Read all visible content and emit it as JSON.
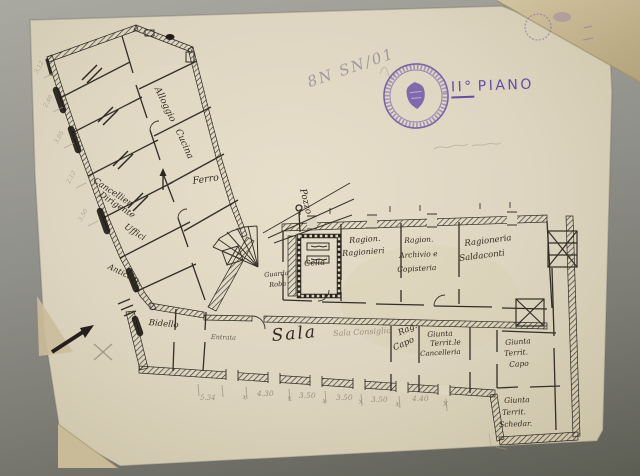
{
  "annotations": {
    "catalog_number": "8N SN/01"
  },
  "stamp": {
    "floor_label_prefix": "II°",
    "floor_label_word": "PIANO",
    "icon": "round-purple-ink-stamp"
  },
  "colors": {
    "paper": "#ddd5c0",
    "paper_fold": "#c8b995",
    "background_gray": "#8c8c84",
    "ink": "#2e2922",
    "pencil": "#a09884",
    "stamp_purple": "#6a4fae"
  },
  "plan": {
    "labels": [
      {
        "name": "room-label-alloggio",
        "text": "Alloggio",
        "x": 160,
        "y": 86,
        "rot": 64,
        "size": 9,
        "cls": "ink"
      },
      {
        "name": "room-label-cucina",
        "text": "Cucina",
        "x": 181,
        "y": 128,
        "rot": 66,
        "size": 9,
        "cls": "ink"
      },
      {
        "name": "room-label-ferro",
        "text": "Ferro",
        "x": 192,
        "y": 177,
        "rot": -8,
        "size": 9.5,
        "cls": "ink"
      },
      {
        "name": "room-label-cancelliere-line1",
        "text": "Cancellier.",
        "x": 96,
        "y": 177,
        "rot": 33,
        "size": 8.5,
        "cls": "ink"
      },
      {
        "name": "room-label-cancelliere-line2",
        "text": "Dirigente",
        "x": 102,
        "y": 191,
        "rot": 33,
        "size": 8.5,
        "cls": "ink"
      },
      {
        "name": "room-label-uffici",
        "text": "Uffici",
        "x": 127,
        "y": 223,
        "rot": 33,
        "size": 8.5,
        "cls": "ink"
      },
      {
        "name": "room-label-anticamera",
        "text": "Anticam.",
        "x": 110,
        "y": 263,
        "rot": 26,
        "size": 8,
        "cls": "ink"
      },
      {
        "name": "room-label-bidello",
        "text": "Bidello",
        "x": 149,
        "y": 319,
        "rot": 5,
        "size": 8.5,
        "cls": "ink"
      },
      {
        "name": "room-label-entrata",
        "text": "Entrata",
        "x": 211,
        "y": 334,
        "rot": 2,
        "size": 6.5,
        "cls": "ink faint"
      },
      {
        "name": "room-label-sala",
        "text": "Sala",
        "x": 271,
        "y": 328,
        "rot": -5,
        "size": 17,
        "cls": "ink big"
      },
      {
        "name": "room-label-sala-consiglio",
        "text": "Sala Consiglio",
        "x": 333,
        "y": 330,
        "rot": -3,
        "size": 8,
        "cls": "pencil"
      },
      {
        "name": "room-label-rag-capo-line1",
        "text": "Rag.",
        "x": 397,
        "y": 330,
        "rot": -24,
        "size": 8.5,
        "cls": "ink"
      },
      {
        "name": "room-label-rag-capo-line2",
        "text": "Capo",
        "x": 392,
        "y": 345,
        "rot": -24,
        "size": 8.5,
        "cls": "ink"
      },
      {
        "name": "room-label-giunta-cancelleria-line1",
        "text": "Giunta",
        "x": 427,
        "y": 331,
        "rot": -3,
        "size": 7.5,
        "cls": "ink"
      },
      {
        "name": "room-label-giunta-cancelleria-line2",
        "text": "Territ.le",
        "x": 430,
        "y": 340,
        "rot": -3,
        "size": 7.5,
        "cls": "ink"
      },
      {
        "name": "room-label-giunta-cancelleria-line3",
        "text": "Cancelleria",
        "x": 420,
        "y": 351,
        "rot": -3,
        "size": 7,
        "cls": "ink"
      },
      {
        "name": "room-label-giunta-capo-line1",
        "text": "Giunta",
        "x": 505,
        "y": 339,
        "rot": -4,
        "size": 7.5,
        "cls": "ink"
      },
      {
        "name": "room-label-giunta-capo-line2",
        "text": "Territ.",
        "x": 504,
        "y": 350,
        "rot": -4,
        "size": 7.5,
        "cls": "ink"
      },
      {
        "name": "room-label-giunta-capo-line3",
        "text": "Capo",
        "x": 509,
        "y": 361,
        "rot": -4,
        "size": 7.5,
        "cls": "ink"
      },
      {
        "name": "room-label-giunta-schedario-line1",
        "text": "Giunta",
        "x": 504,
        "y": 397,
        "rot": -2,
        "size": 7.5,
        "cls": "ink"
      },
      {
        "name": "room-label-giunta-schedario-line2",
        "text": "Territ.",
        "x": 502,
        "y": 409,
        "rot": -2,
        "size": 7.5,
        "cls": "ink"
      },
      {
        "name": "room-label-giunta-schedario-line3",
        "text": "Schedar.",
        "x": 499,
        "y": 421,
        "rot": -2,
        "size": 7.5,
        "cls": "ink"
      },
      {
        "name": "room-label-ragionieri-line1",
        "text": "Ragion.",
        "x": 349,
        "y": 237,
        "rot": -4,
        "size": 8,
        "cls": "ink"
      },
      {
        "name": "room-label-ragionieri-line2",
        "text": "Ragionieri",
        "x": 342,
        "y": 250,
        "rot": -4,
        "size": 8,
        "cls": "ink"
      },
      {
        "name": "room-label-archivio-line1",
        "text": "Ragion.",
        "x": 404,
        "y": 237,
        "rot": -3,
        "size": 7.5,
        "cls": "ink"
      },
      {
        "name": "room-label-archivio-line2",
        "text": "Archivio e",
        "x": 399,
        "y": 252,
        "rot": -3,
        "size": 7.5,
        "cls": "ink"
      },
      {
        "name": "room-label-archivio-line3",
        "text": "Copisteria",
        "x": 397,
        "y": 266,
        "rot": -3,
        "size": 7.5,
        "cls": "ink"
      },
      {
        "name": "room-label-saldaconti-line1",
        "text": "Ragioneria",
        "x": 464,
        "y": 240,
        "rot": -7,
        "size": 8.5,
        "cls": "ink"
      },
      {
        "name": "room-label-saldaconti-line2",
        "text": "Saldaconti",
        "x": 459,
        "y": 255,
        "rot": -7,
        "size": 8.5,
        "cls": "ink"
      },
      {
        "name": "room-label-cella",
        "text": "Cella",
        "x": 304,
        "y": 260,
        "rot": -4,
        "size": 8,
        "cls": "ink"
      },
      {
        "name": "room-label-guardaroba-line1",
        "text": "Guarda",
        "x": 264,
        "y": 272,
        "rot": -5,
        "size": 6.5,
        "cls": "ink"
      },
      {
        "name": "room-label-guardaroba-line2",
        "text": "Roba",
        "x": 269,
        "y": 282,
        "rot": -5,
        "size": 6.5,
        "cls": "ink"
      },
      {
        "name": "room-label-pozzo",
        "text": "Pozzo",
        "x": 306,
        "y": 188,
        "rot": 76,
        "size": 9,
        "cls": "ink"
      },
      {
        "name": "dimension-value",
        "text": "5.34",
        "x": 200,
        "y": 395,
        "rot": 0,
        "size": 7,
        "cls": "pencil"
      },
      {
        "name": "dimension-separator",
        "text": "x",
        "x": 243,
        "y": 393,
        "rot": 10,
        "size": 8,
        "cls": "pencil"
      },
      {
        "name": "dimension-value",
        "text": "4.30",
        "x": 257,
        "y": 390,
        "rot": 0,
        "size": 7.5,
        "cls": "pencil"
      },
      {
        "name": "dimension-separator",
        "text": "x",
        "x": 287,
        "y": 395,
        "rot": -5,
        "size": 8,
        "cls": "pencil"
      },
      {
        "name": "dimension-value",
        "text": "3.50",
        "x": 299,
        "y": 392,
        "rot": 0,
        "size": 7.5,
        "cls": "pencil"
      },
      {
        "name": "dimension-separator",
        "text": "x",
        "x": 323,
        "y": 397,
        "rot": 12,
        "size": 8,
        "cls": "pencil"
      },
      {
        "name": "dimension-value",
        "text": "3.50",
        "x": 336,
        "y": 394,
        "rot": 0,
        "size": 7.5,
        "cls": "pencil"
      },
      {
        "name": "dimension-separator",
        "text": "x",
        "x": 358,
        "y": 398,
        "rot": -8,
        "size": 8,
        "cls": "pencil"
      },
      {
        "name": "dimension-value",
        "text": "3.50",
        "x": 371,
        "y": 396,
        "rot": 0,
        "size": 7.5,
        "cls": "pencil"
      },
      {
        "name": "dimension-separator",
        "text": "x",
        "x": 396,
        "y": 400,
        "rot": 10,
        "size": 8,
        "cls": "pencil"
      },
      {
        "name": "dimension-value",
        "text": "4.40",
        "x": 412,
        "y": 395,
        "rot": 0,
        "size": 7.5,
        "cls": "pencil"
      },
      {
        "name": "dimension-separator",
        "text": "x",
        "x": 443,
        "y": 400,
        "rot": 0,
        "size": 9,
        "cls": "pencil"
      },
      {
        "name": "dimension-wing",
        "text": "3.12",
        "x": 34,
        "y": 72,
        "rot": -62,
        "size": 6,
        "cls": "pencil faint"
      },
      {
        "name": "dimension-wing",
        "text": "2.40",
        "x": 43,
        "y": 106,
        "rot": -62,
        "size": 6,
        "cls": "pencil faint"
      },
      {
        "name": "dimension-wing",
        "text": "3.05",
        "x": 54,
        "y": 142,
        "rot": -62,
        "size": 6,
        "cls": "pencil faint"
      },
      {
        "name": "dimension-wing",
        "text": "2.12",
        "x": 66,
        "y": 182,
        "rot": -62,
        "size": 6,
        "cls": "pencil faint"
      },
      {
        "name": "dimension-wing",
        "text": "3.50",
        "x": 78,
        "y": 220,
        "rot": -62,
        "size": 6,
        "cls": "pencil faint"
      }
    ]
  }
}
